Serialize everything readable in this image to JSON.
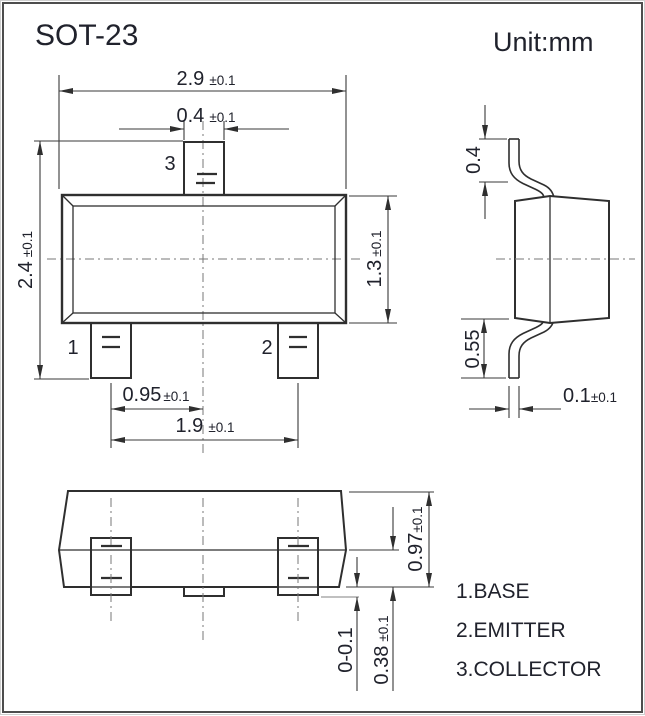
{
  "header": {
    "title": "SOT-23",
    "unit_label": "Unit:mm"
  },
  "top_view": {
    "pin_labels": {
      "pin1": "1",
      "pin2": "2",
      "pin3": "3"
    },
    "dims": {
      "overall_width": {
        "v": "2.9",
        "t": "±0.1"
      },
      "tab_width": {
        "v": "0.4",
        "t": "±0.1"
      },
      "overall_height": {
        "v": "2.4",
        "t": "±0.1"
      },
      "body_height": {
        "v": "1.3",
        "t": "±0.1"
      },
      "lead_pitch": {
        "v": "0.95",
        "t": "±0.1"
      },
      "lead_span": {
        "v": "1.9",
        "t": "±0.1"
      }
    }
  },
  "side_view": {
    "dims": {
      "lead_top_len": {
        "v": "0.4",
        "t": ""
      },
      "lead_bottom_len": {
        "v": "0.55",
        "t": ""
      },
      "lead_thickness": {
        "v": "0.1",
        "t": "±0.1"
      }
    }
  },
  "front_view": {
    "dims": {
      "overall_height": {
        "v": "0.97",
        "t": "±0.1"
      },
      "lead_height": {
        "v": "0.38",
        "t": "±0.1"
      },
      "standoff": {
        "v": "0-0.1",
        "t": ""
      }
    }
  },
  "legend": {
    "items": [
      "1.BASE",
      "2.EMITTER",
      "3.COLLECTOR"
    ]
  },
  "colors": {
    "line": "#2f2f2f",
    "text": "#20222c",
    "centerline": "#777777",
    "border": "#4d4d4d"
  }
}
